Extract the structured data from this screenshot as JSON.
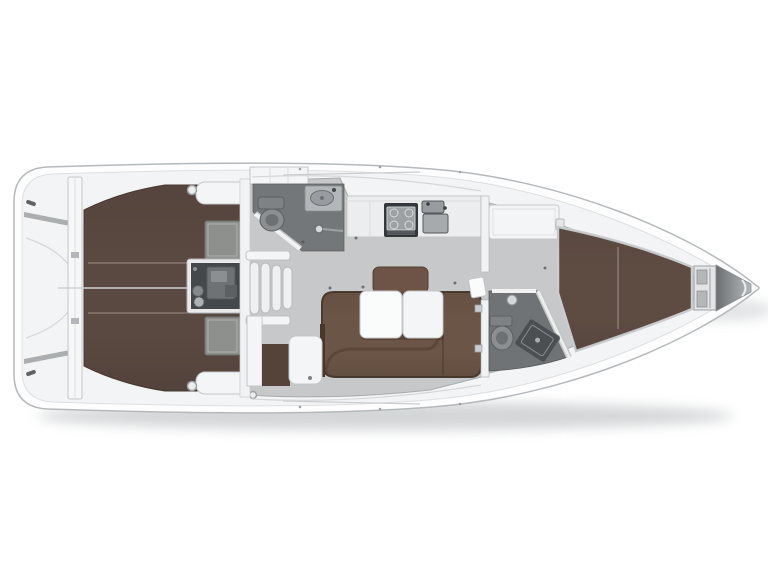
{
  "meta": {
    "subject": "sailing-yacht-interior-layout-floor-plan",
    "view": "top-down",
    "bow_direction": "right",
    "stern_direction": "left",
    "visible_text": ""
  },
  "colors": {
    "background": "#ffffff",
    "hull_white": "#fdfdfe",
    "hull_outline": "#b5b9bb",
    "deck_white": "#f3f4f5",
    "saloon_floor": "#c6c8c9",
    "teak_brown": "#5a4941",
    "settee_brown": "#6b5546",
    "cushion_brown": "#6d5447",
    "berth_brown": "#5e4c43",
    "cabin_entry_brown": "#55433a",
    "wetroom_aft_floor": "#73777a",
    "wetroom_fwd_floor": "#6f7376",
    "hatch_grey": "#8d908c",
    "engine_dark": "#44484b",
    "appliance_dark": "#34383c",
    "bow_wedge_grey": "#888c8f",
    "shadow_grey": "#9fa4a7"
  },
  "areas": [
    {
      "id": "swim-platform",
      "name": "Swim platform / transom",
      "position": "aft",
      "color_key": "deck_white"
    },
    {
      "id": "cockpit",
      "name": "Cockpit with teak floor",
      "position": "aft",
      "color_key": "teak_brown"
    },
    {
      "id": "cockpit-benches",
      "name": "Cockpit bench seats",
      "position": "aft",
      "color_key": "deck_white"
    },
    {
      "id": "engine-compartment",
      "name": "Engine compartment",
      "position": "aft of companionway",
      "color_key": "engine_dark"
    },
    {
      "id": "companionway-steps",
      "name": "Companionway steps",
      "position": "centerline aft",
      "color_key": "deck_white"
    },
    {
      "id": "aft-head",
      "name": "Aft head with toilet, washbasin and shower",
      "position": "port aft of saloon",
      "color_key": "wetroom_aft_floor"
    },
    {
      "id": "galley",
      "name": "Galley with stove and twin sinks",
      "position": "port midship",
      "color_key": "appliance_dark"
    },
    {
      "id": "dinette",
      "name": "Saloon dinette with U-settee and folding table",
      "position": "starboard midship",
      "color_key": "settee_brown"
    },
    {
      "id": "chart-table",
      "name": "Chart table with seat",
      "position": "starboard aft of saloon",
      "color_key": "deck_white"
    },
    {
      "id": "wardrobe",
      "name": "Wardrobe locker",
      "position": "starboard aft of saloon",
      "color_key": "deck_white"
    },
    {
      "id": "forward-head",
      "name": "Forward head with toilet and shower tray",
      "position": "starboard forward",
      "color_key": "wetroom_fwd_floor"
    },
    {
      "id": "forward-cabin",
      "name": "Forward cabin with V-berth",
      "position": "bow",
      "color_key": "berth_brown"
    },
    {
      "id": "anchor-locker",
      "name": "Anchor locker",
      "position": "bow tip",
      "color_key": "deck_white"
    }
  ]
}
